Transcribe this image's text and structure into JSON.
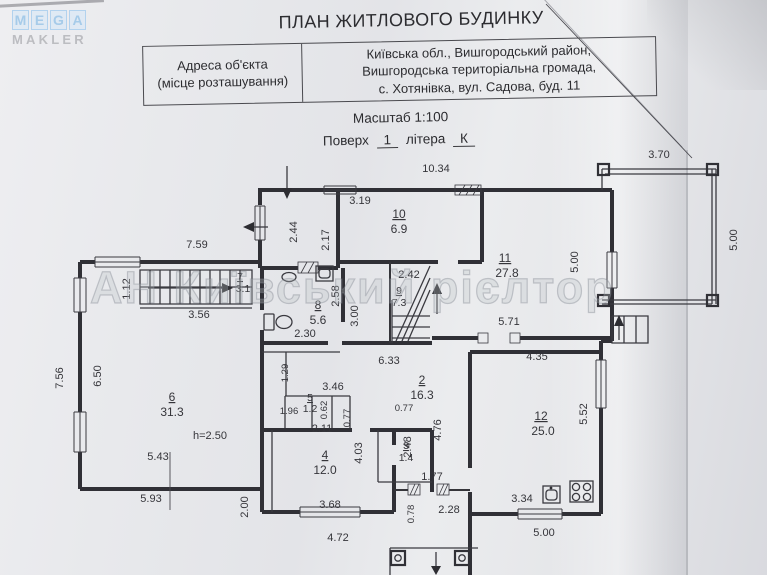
{
  "logo": {
    "letters": [
      "M",
      "E",
      "G",
      "A"
    ],
    "subtitle": "MAKLER"
  },
  "header": {
    "title": "ПЛАН ЖИТЛОВОГО БУДИНКУ",
    "address_label": [
      "Адреса об'єкта",
      "(місце розташування)"
    ],
    "address_value": [
      "Київська обл., Вишгородський район,",
      "Вишгородська територіальна громада,",
      "с. Хотянівка, вул. Садова, буд. 11"
    ],
    "scale_text": "Масштаб 1:100",
    "floor_label": "Поверх",
    "floor_value": "1",
    "letter_label": "літера",
    "letter_value": "К"
  },
  "watermark": "АН Київський рієлтор",
  "plan": {
    "height_note": "h=2.50",
    "rooms": [
      {
        "n": "2",
        "a": "16.3"
      },
      {
        "n": "3",
        "a": "1.4"
      },
      {
        "n": "4",
        "a": "12.0"
      },
      {
        "n": "5",
        "a": "1.2"
      },
      {
        "n": "6",
        "a": "31.3"
      },
      {
        "n": "7",
        "a": "3.1"
      },
      {
        "n": "8",
        "a": "5.6"
      },
      {
        "n": "9",
        "a": "7.3"
      },
      {
        "n": "10",
        "a": "6.9"
      },
      {
        "n": "11",
        "a": "27.8"
      },
      {
        "n": "12",
        "a": "25.0"
      }
    ],
    "dims": [
      {
        "t": "10.34"
      },
      {
        "t": "3.70"
      },
      {
        "t": "5.00"
      },
      {
        "t": "2.44"
      },
      {
        "t": "3.19"
      },
      {
        "t": "2.17"
      },
      {
        "t": "7.59"
      },
      {
        "t": "1.12"
      },
      {
        "t": "2.42"
      },
      {
        "t": "5.00"
      },
      {
        "t": "3.56"
      },
      {
        "t": "2.30"
      },
      {
        "t": "2.58"
      },
      {
        "t": "3.00"
      },
      {
        "t": "5.71"
      },
      {
        "t": "7.56"
      },
      {
        "t": "6.50"
      },
      {
        "t": "6.33"
      },
      {
        "t": "4.35"
      },
      {
        "t": "1.29"
      },
      {
        "t": "3.46"
      },
      {
        "t": "1.96"
      },
      {
        "t": "0.62"
      },
      {
        "t": "0.77"
      },
      {
        "t": "0.77"
      },
      {
        "t": "2.11"
      },
      {
        "t": "4.03"
      },
      {
        "t": "2.48"
      },
      {
        "t": "4.76"
      },
      {
        "t": "5.52"
      },
      {
        "t": "5.43"
      },
      {
        "t": "5.93"
      },
      {
        "t": "h=2.50"
      },
      {
        "t": "3.68"
      },
      {
        "t": "4.72"
      },
      {
        "t": "2.00"
      },
      {
        "t": "1.77"
      },
      {
        "t": "0.78"
      },
      {
        "t": "2.28"
      },
      {
        "t": "3.34"
      },
      {
        "t": "5.00"
      }
    ]
  }
}
